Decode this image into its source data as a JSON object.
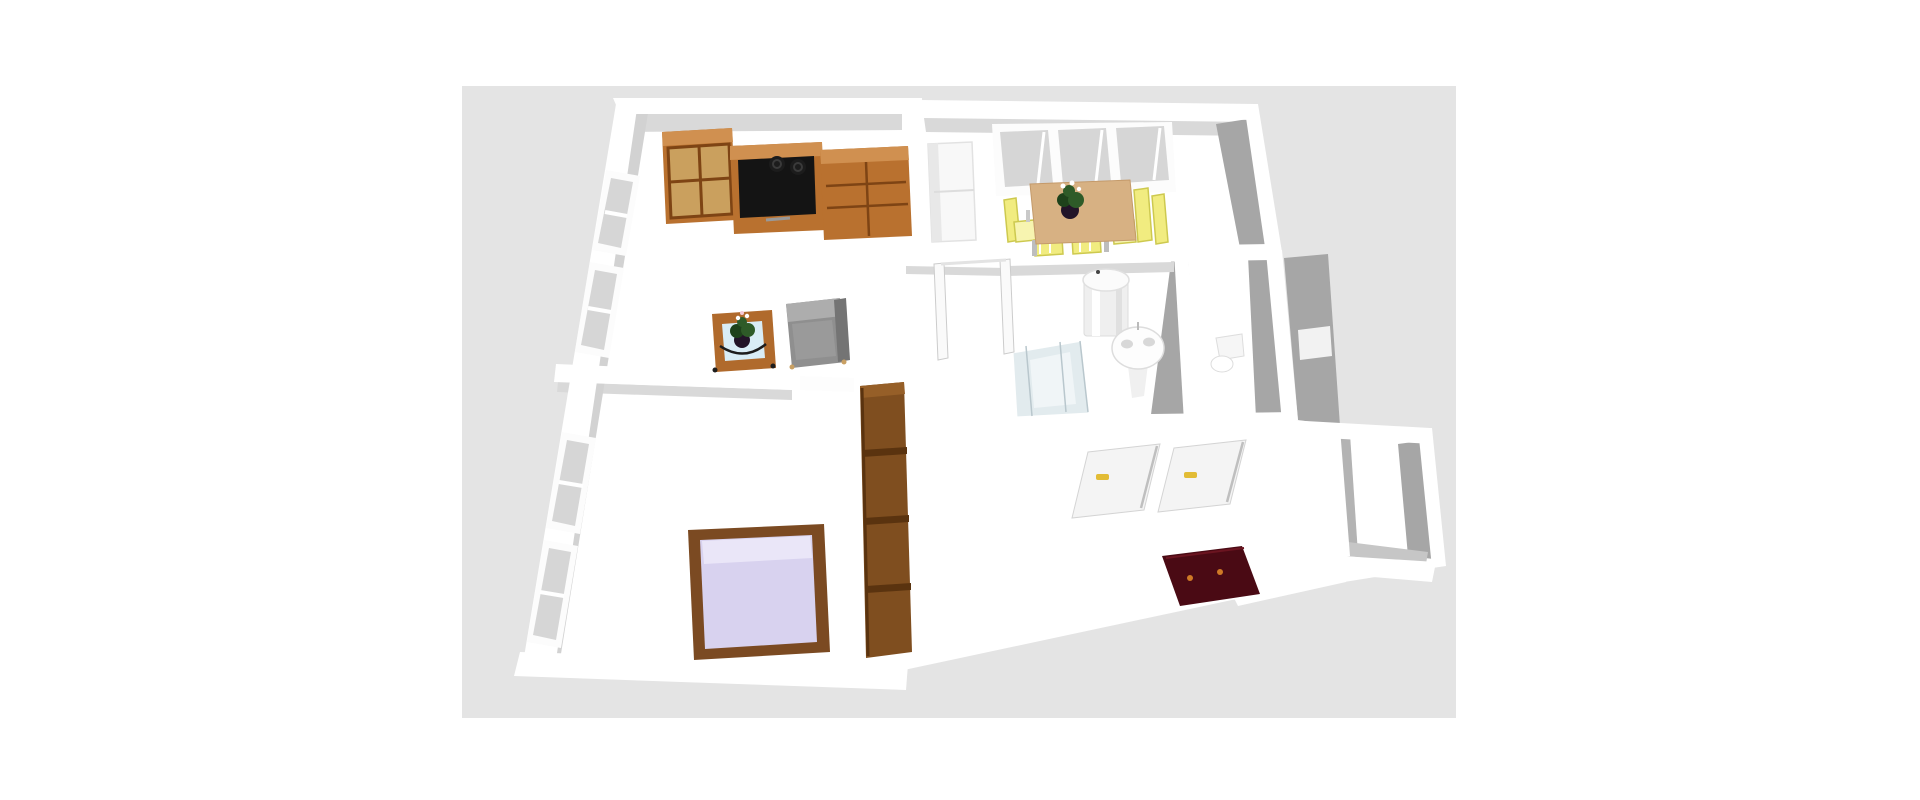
{
  "scene": {
    "type": "3d-floor-plan-render",
    "page_background": "#ffffff",
    "viewport": {
      "background": "#e4e4e4",
      "x": 462,
      "y": 86,
      "width": 994,
      "height": 632
    },
    "palette": {
      "wall_top": "#ffffff",
      "wall_face": "#d9d9d9",
      "wall_face_dark": "#a6a6a6",
      "floor": "#ffffff",
      "wood": "#b9712f",
      "wood_light": "#d09050",
      "wood_dark": "#7e4414",
      "wood_pane": "#caa05e",
      "tv": "#141414",
      "speaker": "#1c1c1c",
      "sofa": "#8f8f8f",
      "sofa_light": "#adadad",
      "sofa_dark": "#747474",
      "table_glass": "#d9edf6",
      "coffee_frame": "#b06a2c",
      "plant_green": "#2e5b28",
      "plant_dark": "#1e421b",
      "plant_pot": "#221428",
      "flower": "#ffffff",
      "dining_table": "#d7b183",
      "chair_yellow": "#f1ec80",
      "chair_edge": "#cdc94f",
      "fridge": "#f8f8f8",
      "window_glass": "#d6d6d6",
      "window_frame": "#fcfcfc",
      "heater": "#efefef",
      "sink": "#fdfdfd",
      "shower_glass": "#e2ebee",
      "shower_tray": "#f0f5f7",
      "door_panel": "#f4f4f4",
      "door_edge": "#c9c9c9",
      "handle_yellow": "#e2bc35",
      "cabinet_maroon": "#4a0a14",
      "maroon_handle": "#cf7a26",
      "bed_frame": "#7b4a22",
      "bed_sheet": "#d8d2ef",
      "bed_sheet_light": "#eae6f8",
      "wardrobe": "#7f4e1f",
      "wardrobe_dark": "#5a330f",
      "wardrobe_top": "#965f28"
    },
    "rooms": [
      {
        "name": "living-room"
      },
      {
        "name": "dining-room"
      },
      {
        "name": "bathroom"
      },
      {
        "name": "toilet-room"
      },
      {
        "name": "hallway"
      },
      {
        "name": "bedroom"
      },
      {
        "name": "entry-room"
      }
    ],
    "objects": [
      {
        "name": "bookcase",
        "room": "living-room",
        "color_ref": "wood"
      },
      {
        "name": "tv-stand-with-tv",
        "room": "living-room",
        "color_ref": "wood"
      },
      {
        "name": "speakers",
        "room": "living-room",
        "color_ref": "speaker",
        "count": 2
      },
      {
        "name": "sideboard",
        "room": "living-room",
        "color_ref": "wood"
      },
      {
        "name": "coffee-table-with-plant",
        "room": "living-room",
        "color_ref": "coffee_frame"
      },
      {
        "name": "armchair",
        "room": "living-room",
        "color_ref": "sofa"
      },
      {
        "name": "windows-left-wall",
        "room": "living-room/bedroom",
        "count": 4
      },
      {
        "name": "fridge-cabinet",
        "room": "dining-room",
        "color_ref": "fridge"
      },
      {
        "name": "dining-table-with-plant",
        "room": "dining-room",
        "color_ref": "dining_table"
      },
      {
        "name": "dining-chairs",
        "room": "dining-room",
        "color_ref": "chair_yellow",
        "count": 5
      },
      {
        "name": "windows-top-wall",
        "room": "dining-room",
        "count": 3
      },
      {
        "name": "water-heater",
        "room": "bathroom",
        "color_ref": "heater"
      },
      {
        "name": "pedestal-sink",
        "room": "bathroom",
        "color_ref": "sink"
      },
      {
        "name": "shower",
        "room": "bathroom",
        "color_ref": "shower_glass"
      },
      {
        "name": "toilet",
        "room": "toilet-room",
        "color_ref": "sink"
      },
      {
        "name": "open-door-frame",
        "room": "hallway"
      },
      {
        "name": "tall-wardrobe",
        "room": "hallway",
        "color_ref": "wardrobe"
      },
      {
        "name": "flat-closet-doors",
        "room": "hallway",
        "color_ref": "door_panel",
        "count": 2
      },
      {
        "name": "entry-cabinet",
        "room": "hallway",
        "color_ref": "cabinet_maroon"
      },
      {
        "name": "double-bed",
        "room": "bedroom",
        "color_ref": "bed_sheet"
      }
    ]
  }
}
